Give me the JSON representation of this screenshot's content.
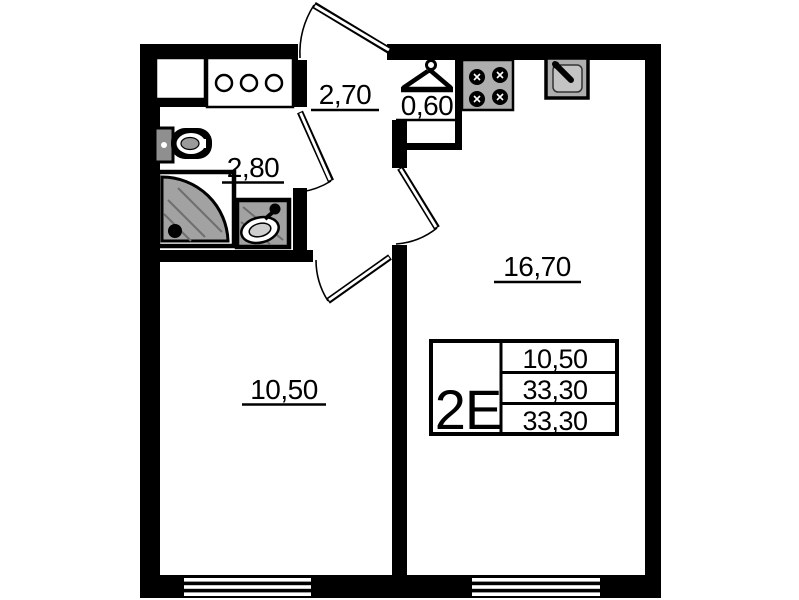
{
  "floor_plan": {
    "unit_type": "2Е",
    "room_areas": {
      "hallway": "2,70",
      "wardrobe_niche": "0,60",
      "bathroom": "2,80",
      "kitchen_living": "16,70",
      "room": "10,50"
    },
    "info_table": {
      "type": "2Е",
      "rows": [
        "10,50",
        "33,30",
        "33,30"
      ]
    },
    "colors": {
      "wall": "#000000",
      "background": "#ffffff",
      "fixture_gray": "#a2a2a2",
      "fixture_gray_light": "#c4c4c4"
    }
  }
}
